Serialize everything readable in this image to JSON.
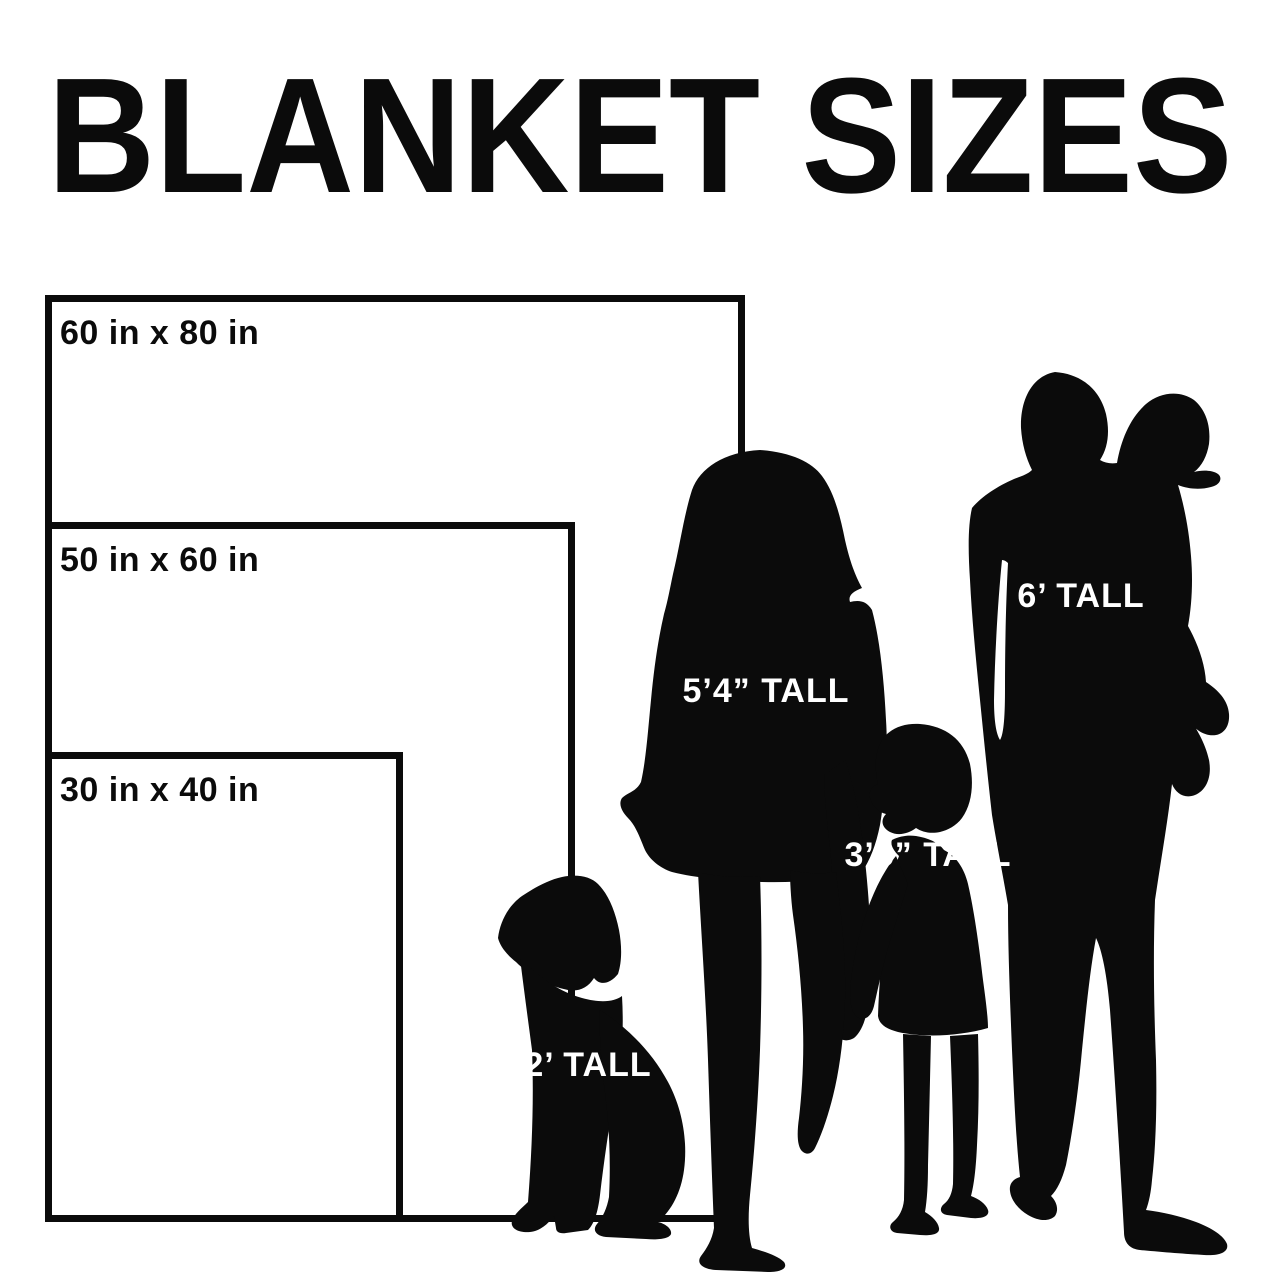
{
  "title": "BLANKET SIZES",
  "colors": {
    "ink": "#0b0b0b",
    "background": "#ffffff",
    "figure_label_text": "#ffffff"
  },
  "blankets": [
    {
      "id": "60x80",
      "label": "60 in x 80 in"
    },
    {
      "id": "50x60",
      "label": "50 in x 60 in"
    },
    {
      "id": "30x40",
      "label": "30 in x 40 in"
    }
  ],
  "figures": [
    {
      "id": "woman",
      "height_label": "5’4” TALL"
    },
    {
      "id": "man-with-toddler",
      "height_label": "6’ TALL"
    },
    {
      "id": "child",
      "height_label": "3’5” TALL"
    },
    {
      "id": "dog",
      "height_label": "2’ TALL"
    }
  ]
}
